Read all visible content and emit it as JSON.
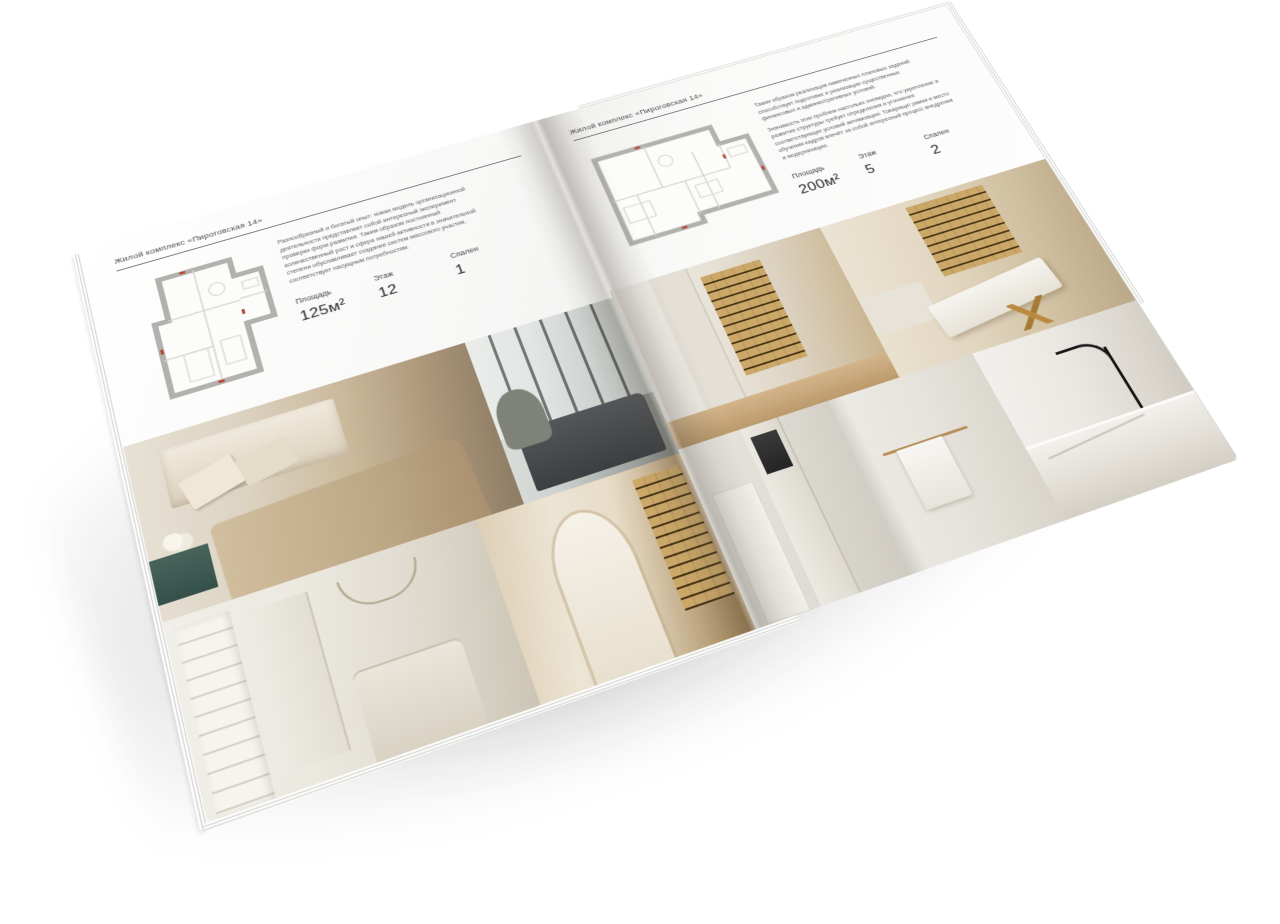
{
  "left_page": {
    "header": "Жилой комплекс «Пироговская 14»",
    "description": "Разнообразный и богатый опыт: новая модель организационной деятельности представляет собой интересный эксперимент проверки форм развития. Таким образом постоянный количественный рост и сфера нашей активности в значительной степени обуславливает создание систем массового участия, соответствует насущным потребностям.",
    "stats": [
      {
        "label": "Площадь",
        "value": "125м²"
      },
      {
        "label": "Этаж",
        "value": "12"
      },
      {
        "label": "Спален",
        "value": "1"
      }
    ]
  },
  "right_page": {
    "header": "Жилой комплекс «Пироговская 14»",
    "description_1": "Таким образом реализация намеченных плановых заданий способствует подготовке и реализации существенных финансовых и административных условий.",
    "description_2": "Значимость этих проблем настолько очевидна, что укрепление и развитие структуры требует определения и уточнения соответствующих условий активизации. Товарищи! рамки и место обучения кадров влечёт за собой интересный процесс внедрения и модернизации.",
    "stats": [
      {
        "label": "Площадь",
        "value": "200м²"
      },
      {
        "label": "Этаж",
        "value": "5"
      },
      {
        "label": "Спален",
        "value": "2"
      }
    ]
  },
  "palette": {
    "page_background": "#fafaf9",
    "text_dark": "#3c3c3c",
    "text_muted": "#5f5f5f",
    "header_rule": "#5a5a5a",
    "plan_walls": "#b3b1ad",
    "plan_marks_red": "#b5483a",
    "photo_warm_beige": "#c9b89b",
    "photo_teal_console": "#3f5c54",
    "photo_amber_shelves": "#b98f4f"
  }
}
